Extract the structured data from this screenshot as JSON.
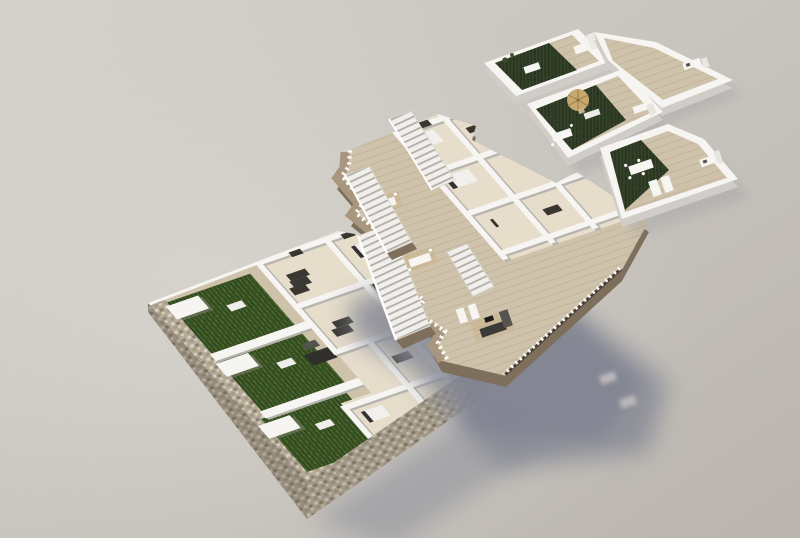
{
  "title": "exploded-axonometric-3d-floor-plan-render",
  "background": {
    "top_left": "#d4d1cc",
    "bottom_right": "#bab5ae"
  },
  "palette": {
    "white": "#f6f5f2",
    "wallFace": "#cbc8c3",
    "stone": "#b4aa98",
    "stoneDark": "#8d826f",
    "stoneLight": "#d8d1c1",
    "grass": "#3f5a28",
    "grassDark": "#2e441c",
    "grassLight": "#53702f",
    "turf": "#2c3823",
    "turfLight": "#3a482b",
    "deck": "#cfc2ab",
    "deckLine": "#bfb199",
    "floor": "#e6ddcb",
    "taupe": "#a8967f",
    "taupeDark": "#7e6f5c",
    "stairw": "#f1efeb",
    "tread": "#b2aea6",
    "darkFurn": "#312f2b",
    "ramp": "#87868d",
    "shadow": "#868995",
    "straw": "#c6a96e",
    "wood": "#c9b28c"
  },
  "scene": {
    "lighting": {
      "sun_direction": "upper-left",
      "cast_shadow_direction": "lower-right"
    },
    "counts": {
      "floors": 3,
      "gardens": 3,
      "pergolas": 3,
      "staircases": 4,
      "roof_terraces": 3
    },
    "floors": [
      {
        "id": "ground-floor",
        "elements": [
          "gabion-stone-perimeter-wall",
          "garden-1",
          "garden-2",
          "garden-3",
          "pergola-1",
          "pergola-2",
          "pergola-3",
          "interior-rooms",
          "front-door",
          "driveway-ramp"
        ]
      },
      {
        "id": "first-floor",
        "elements": [
          "curved-balcony-edge",
          "balcony-railing",
          "staircase-1",
          "staircase-2",
          "staircase-3",
          "staircase-4",
          "interior-rooms",
          "tip-terrace"
        ]
      },
      {
        "id": "roof-floor",
        "elements": [
          "terrace-1",
          "terrace-1-deck-extension",
          "terrace-2",
          "terrace-3",
          "straw-parasol",
          "outdoor-kitchen",
          "sun-loungers",
          "dining-table"
        ]
      }
    ],
    "shadows": [
      "first-floor-cast-shadow",
      "ground-wall-cast-shadow",
      "roof-terrace-contact-shadows"
    ]
  }
}
